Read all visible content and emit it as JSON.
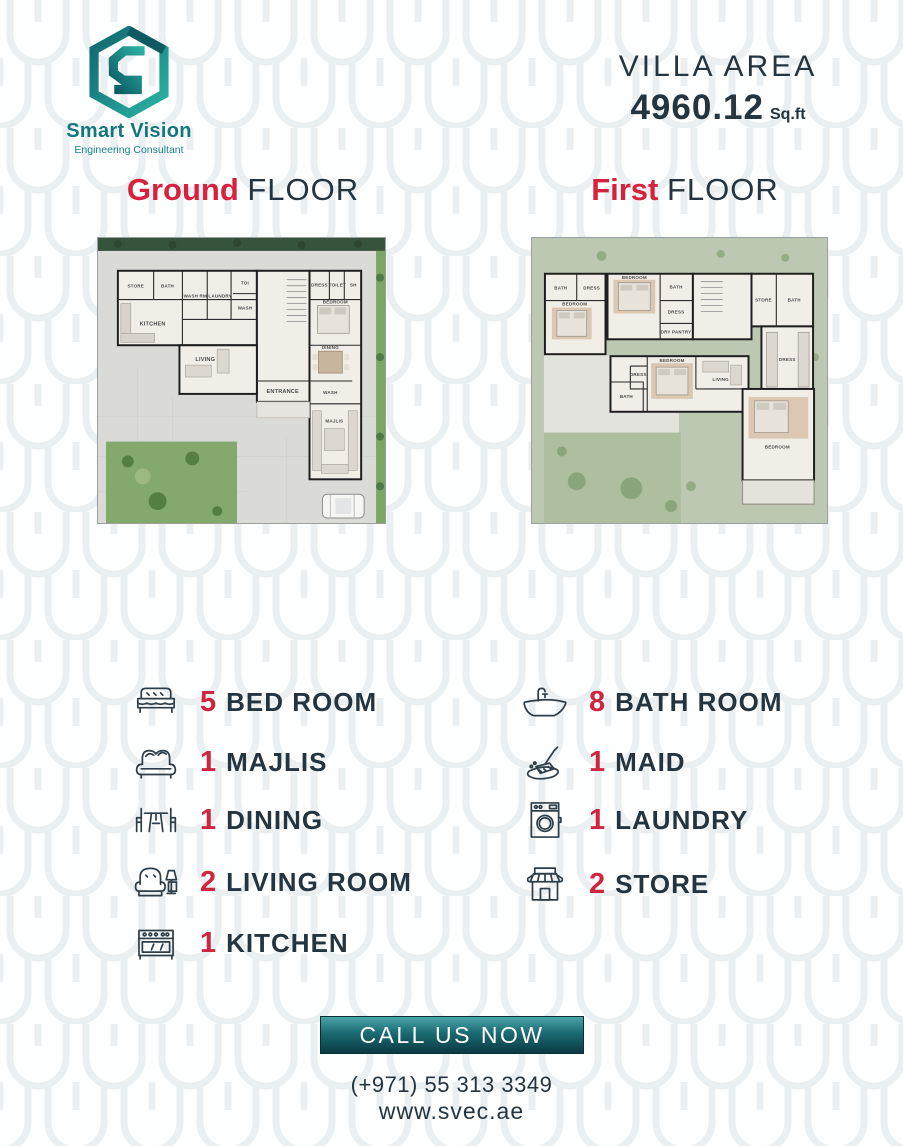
{
  "logo": {
    "name": "Smart Vision",
    "tagline": "Engineering Consultant"
  },
  "header": {
    "villa_area_label": "VILLA AREA",
    "villa_area_value": "4960.12",
    "villa_area_unit": "Sq.ft"
  },
  "floors": {
    "ground": {
      "accent": "Ground",
      "rest": "FLOOR"
    },
    "first": {
      "accent": "First",
      "rest": "FLOOR"
    }
  },
  "floor_plans": {
    "ground": {
      "rooms": [
        "STORE",
        "BATH",
        "WASH RM",
        "LAUNDRY",
        "TOI",
        "WASH",
        "KITCHEN",
        "LIVING",
        "ENTRANCE",
        "DRESS",
        "TOILET",
        "SH",
        "BEDROOM",
        "DINING",
        "WASH",
        "MAJLIS"
      ]
    },
    "first": {
      "rooms": [
        "BATH",
        "DRESS",
        "BEDROOM",
        "BEDROOM",
        "BATH",
        "DRESS",
        "DRY PANTRY",
        "STORE",
        "BATH",
        "DRESS",
        "BEDROOM",
        "DRESS",
        "BATH",
        "LIVING",
        "BEDROOM"
      ]
    }
  },
  "amenities": {
    "left": [
      {
        "count": "5",
        "label": "BED ROOM",
        "icon": "bed-icon"
      },
      {
        "count": "1",
        "label": "MAJLIS",
        "icon": "sofa-icon"
      },
      {
        "count": "1",
        "label": "DINING",
        "icon": "dining-icon"
      },
      {
        "count": "2",
        "label": "LIVING ROOM",
        "icon": "armchair-icon"
      },
      {
        "count": "1",
        "label": "KITCHEN",
        "icon": "stove-icon"
      }
    ],
    "right": [
      {
        "count": "8",
        "label": "BATH ROOM",
        "icon": "bathtub-icon"
      },
      {
        "count": "1",
        "label": "MAID",
        "icon": "maid-icon"
      },
      {
        "count": "1",
        "label": "LAUNDRY",
        "icon": "washing-machine-icon"
      },
      {
        "count": "2",
        "label": "STORE",
        "icon": "store-icon"
      }
    ]
  },
  "footer": {
    "cta": "CALL US NOW",
    "phone": "(+971) 55 313 3349",
    "website": "www.svec.ae"
  },
  "colors": {
    "accent_red": "#d6223d",
    "dark_slate": "#24353f",
    "teal": "#15767d",
    "button_dark": "#0b3a42"
  }
}
